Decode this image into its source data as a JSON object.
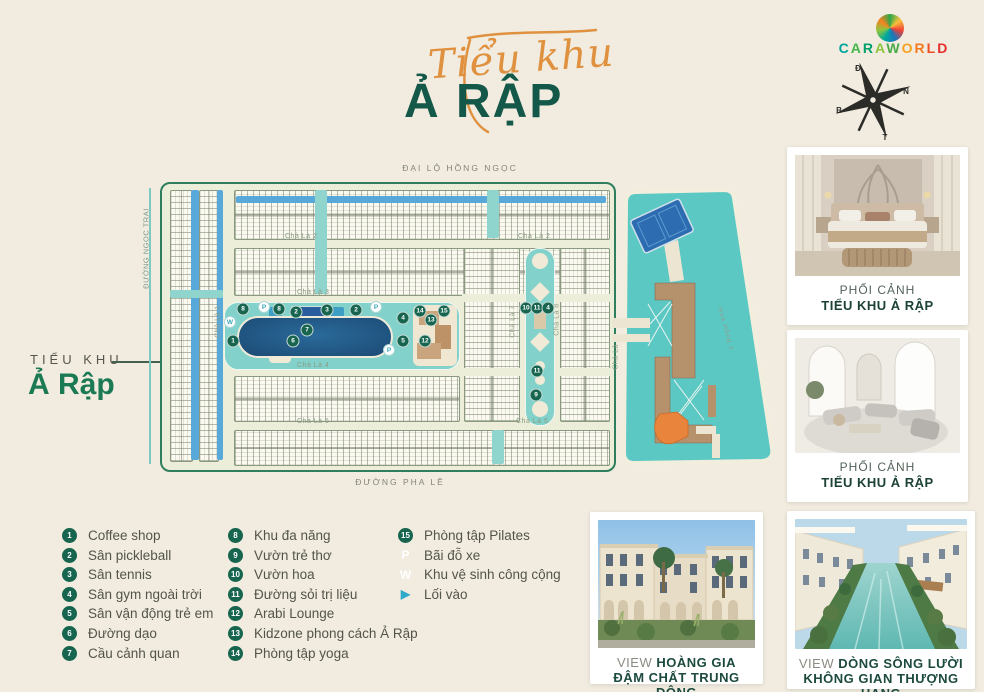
{
  "colors": {
    "accent_orange": "#e09140",
    "brand_green": "#14584a",
    "teal_water": "#5cc8c4",
    "canal_blue": "#58a9d9",
    "marker_green": "#17654f",
    "lagoon_navy": "#1c4a74"
  },
  "header": {
    "title_script": "Tiểu khu",
    "title_main": "Ả RẬP",
    "brand_letters": [
      [
        "C",
        "#00a59b"
      ],
      [
        "A",
        "#44b649"
      ],
      [
        "R",
        "#00a06b"
      ],
      [
        "A",
        "#8cc63f"
      ],
      [
        "W",
        "#4aa948"
      ],
      [
        "O",
        "#f7a01d"
      ],
      [
        "R",
        "#f47a20"
      ],
      [
        "L",
        "#ef4d25"
      ],
      [
        "D",
        "#e62e2e"
      ]
    ],
    "compass": {
      "d": "Đ",
      "n": "N",
      "b": "B",
      "t": "T"
    }
  },
  "side_label": {
    "line1": "TIỂU KHU",
    "line2": "Ả Rập"
  },
  "map": {
    "streets": {
      "top": "ĐẠI LỘ HỒNG NGỌC",
      "bottom": "ĐƯỜNG PHA LÊ",
      "left": "ĐƯỜNG NGỌC TRAI",
      "cha_la_1": "Chà Là 1",
      "cha_la_2a": "Chà Là 2",
      "cha_la_2b": "Chà Là 2",
      "cha_la_3": "Chà Là 3",
      "cha_la_4": "Chà Là 4",
      "cha_la_5a": "Chà Là 5",
      "cha_la_5b": "Chà Là 5",
      "cha_la_6": "Chà Là 6",
      "cha_la_7": "Chà Là 7",
      "cha_la_8": "Chà Là 8",
      "hoa_hong_1": "Hoa Hồng 1"
    },
    "markers": [
      {
        "t": "8",
        "x": 243,
        "y": 309,
        "k": "g"
      },
      {
        "t": "P",
        "x": 264,
        "y": 307,
        "k": "w"
      },
      {
        "t": "8",
        "x": 279,
        "y": 309,
        "k": "g"
      },
      {
        "t": "2",
        "x": 296,
        "y": 312,
        "k": "g"
      },
      {
        "t": "3",
        "x": 327,
        "y": 310,
        "k": "g"
      },
      {
        "t": "2",
        "x": 356,
        "y": 310,
        "k": "g"
      },
      {
        "t": "P",
        "x": 376,
        "y": 307,
        "k": "w"
      },
      {
        "t": "4",
        "x": 403,
        "y": 318,
        "k": "g"
      },
      {
        "t": "W",
        "x": 230,
        "y": 322,
        "k": "w"
      },
      {
        "t": "1",
        "x": 233,
        "y": 341,
        "k": "g"
      },
      {
        "t": "6",
        "x": 293,
        "y": 341,
        "k": "g"
      },
      {
        "t": "7",
        "x": 307,
        "y": 330,
        "k": "g"
      },
      {
        "t": "5",
        "x": 403,
        "y": 341,
        "k": "g"
      },
      {
        "t": "P",
        "x": 389,
        "y": 350,
        "k": "w"
      },
      {
        "t": "14",
        "x": 420,
        "y": 311,
        "k": "g"
      },
      {
        "t": "15",
        "x": 444,
        "y": 311,
        "k": "g"
      },
      {
        "t": "13",
        "x": 431,
        "y": 320,
        "k": "g"
      },
      {
        "t": "12",
        "x": 425,
        "y": 341,
        "k": "g"
      },
      {
        "t": "10",
        "x": 526,
        "y": 308,
        "k": "g"
      },
      {
        "t": "11",
        "x": 537,
        "y": 308,
        "k": "g"
      },
      {
        "t": "4",
        "x": 548,
        "y": 308,
        "k": "g"
      },
      {
        "t": "11",
        "x": 537,
        "y": 371,
        "k": "g"
      },
      {
        "t": "9",
        "x": 536,
        "y": 395,
        "k": "g"
      }
    ]
  },
  "legend": {
    "columns": [
      [
        {
          "marker": "1",
          "type": "num",
          "label": "Coffee shop"
        },
        {
          "marker": "2",
          "type": "num",
          "label": "Sân pickleball"
        },
        {
          "marker": "3",
          "type": "num",
          "label": "Sân tennis"
        },
        {
          "marker": "4",
          "type": "num",
          "label": "Sân gym ngoài trời"
        },
        {
          "marker": "5",
          "type": "num",
          "label": "Sân vận động trẻ em"
        },
        {
          "marker": "6",
          "type": "num",
          "label": "Đường dạo"
        },
        {
          "marker": "7",
          "type": "num",
          "label": "Cầu cảnh quan"
        }
      ],
      [
        {
          "marker": "8",
          "type": "num",
          "label": "Khu đa năng"
        },
        {
          "marker": "9",
          "type": "num",
          "label": "Vườn trẻ thơ"
        },
        {
          "marker": "10",
          "type": "num",
          "label": "Vườn hoa"
        },
        {
          "marker": "11",
          "type": "num",
          "label": "Đường sỏi trị liệu"
        },
        {
          "marker": "12",
          "type": "num",
          "label": "Arabi Lounge"
        },
        {
          "marker": "13",
          "type": "num",
          "label": "Kidzone phong cách Ả Rập"
        },
        {
          "marker": "14",
          "type": "num",
          "label": "Phòng tập yoga"
        }
      ],
      [
        {
          "marker": "15",
          "type": "num",
          "label": "Phòng tập Pilates"
        },
        {
          "marker": "P",
          "type": "white",
          "label": "Bãi đỗ xe"
        },
        {
          "marker": "W",
          "type": "white",
          "label": "Khu vệ sinh công cộng"
        },
        {
          "marker": "▶",
          "type": "arrow",
          "label": "Lối vào"
        }
      ]
    ]
  },
  "photos": [
    {
      "line1": "PHỐI CẢNH",
      "line2": "TIỂU KHU Ả RẬP"
    },
    {
      "line1": "PHỐI CẢNH",
      "line2": "TIỂU KHU Ả RẬP"
    },
    {
      "prefix": "VIEW ",
      "line1": "HOÀNG GIA",
      "line2": "ĐẬM CHẤT TRUNG ĐÔNG"
    },
    {
      "prefix": "VIEW ",
      "line1": "DÒNG SÔNG LƯỜI",
      "line2": "KHÔNG GIAN THƯỢNG HẠNG"
    }
  ]
}
